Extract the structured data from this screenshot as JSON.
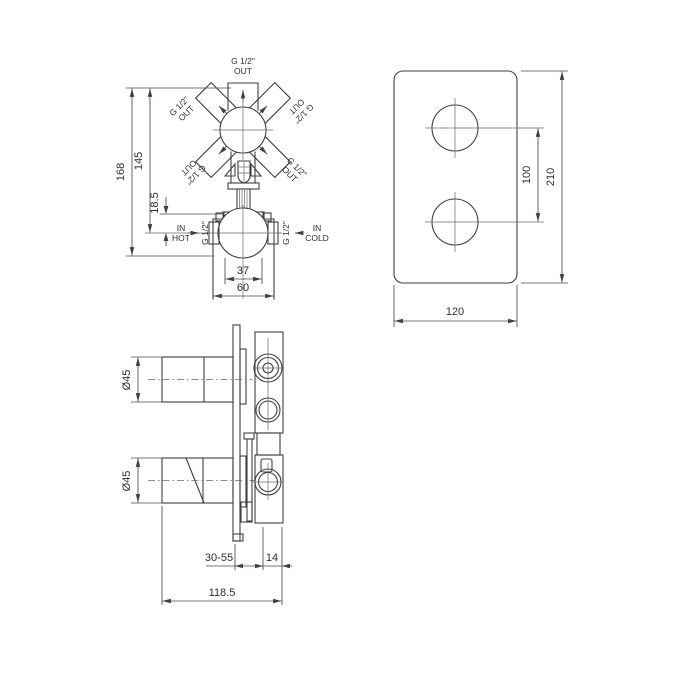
{
  "front_view": {
    "outlet_top": {
      "size": "G 1/2\"",
      "dir": "OUT"
    },
    "outlet_upper_left": {
      "size": "G 1/2\"",
      "dir": "OUT"
    },
    "outlet_upper_right": {
      "size": "G 1/2\"",
      "dir": "OUT"
    },
    "outlet_lower_left": {
      "size": "G 1/2\"",
      "dir": "OUT"
    },
    "outlet_lower_right": {
      "size": "G 1/2\"",
      "dir": "OUT"
    },
    "inlet_hot": {
      "dir": "IN",
      "label": "HOT",
      "size": "G 1/2\""
    },
    "inlet_cold": {
      "dir": "IN",
      "label": "COLD",
      "size": "G 1/2\""
    },
    "dims": {
      "total_height": "168",
      "inlet_height": "145",
      "offset": "18.5",
      "body_width": "37",
      "bracket_width": "60"
    }
  },
  "plate_view": {
    "dims": {
      "hole_spacing": "100",
      "height": "210",
      "width": "120"
    }
  },
  "side_view": {
    "dims": {
      "top_handle_diameter": "Ø45",
      "bottom_handle_diameter": "Ø45",
      "wall_depth_range": "30-55",
      "trim_depth": "14",
      "total_depth": "118.5"
    }
  }
}
